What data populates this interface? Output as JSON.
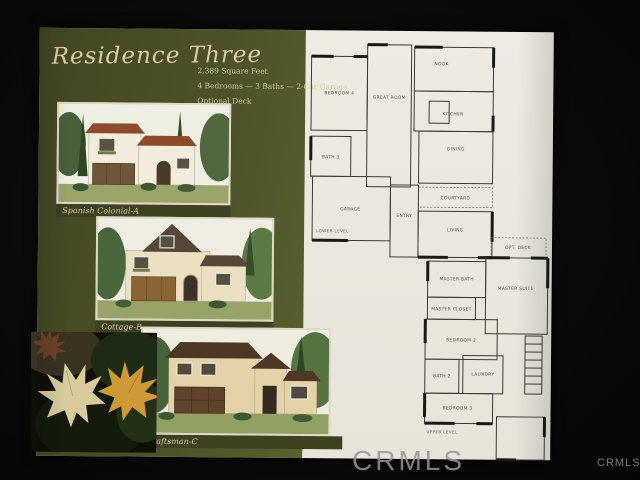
{
  "watermarks": {
    "center": "CRMLS",
    "corner": "CRMLS"
  },
  "page": {
    "header": {
      "title": "Residence Three",
      "spec_line1": "2,389 Square Feet",
      "spec_line2": "4 Bedrooms — 3 Baths — 2-Car Garage",
      "spec_line3": "Optional Deck"
    },
    "elevations": [
      {
        "caption": "Spanish Colonial-A",
        "style": "spanish-colonial"
      },
      {
        "caption": "Cottage-B",
        "style": "cottage"
      },
      {
        "caption": "Craftsman-C",
        "style": "craftsman"
      }
    ],
    "floorplan_lower": {
      "level_label": "LOWER LEVEL",
      "rooms": {
        "bedroom4": "BEDROOM 4",
        "bath3": "BATH 3",
        "great_room": "GREAT ROOM",
        "nook": "NOOK",
        "kitchen": "KITCHEN",
        "dining": "DINING",
        "courtyard": "COURTYARD",
        "living": "LIVING",
        "entry": "ENTRY",
        "garage": "GARAGE"
      }
    },
    "floorplan_upper": {
      "level_label": "UPPER LEVEL",
      "rooms": {
        "opt_deck": "OPT. DECK",
        "master_bath": "MASTER BATH",
        "master_suite": "MASTER SUITE",
        "master_closet": "MASTER CLOSET",
        "bedroom2": "BEDROOM 2",
        "bath2": "BATH 2",
        "laundry": "LAUNDRY",
        "bedroom3": "BEDROOM 3"
      }
    },
    "colors": {
      "panel_green": "#4c5127",
      "caption_band": "#3d4120",
      "cream_text": "#d6cb9e",
      "page_white": "#eae8df"
    }
  }
}
